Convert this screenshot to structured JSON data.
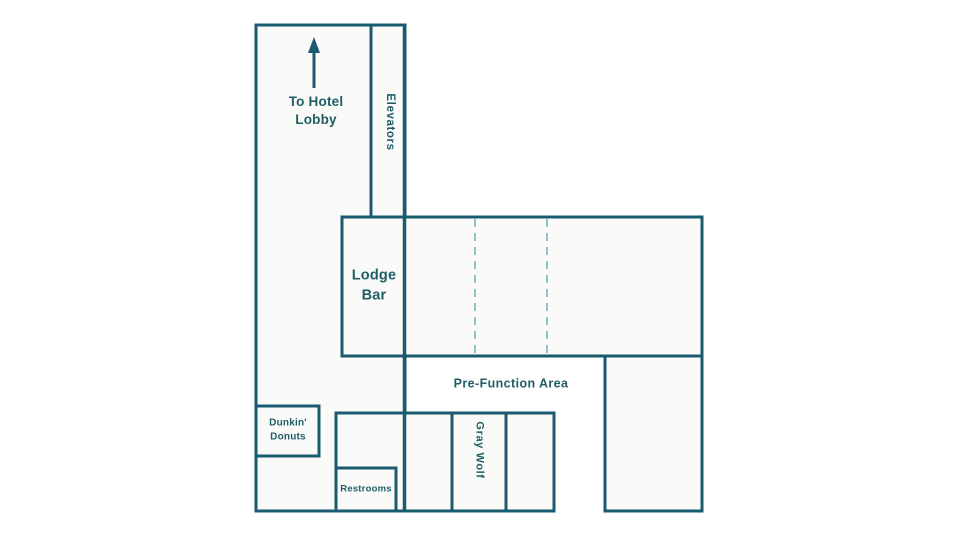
{
  "floor_plan": {
    "labels": {
      "to_hotel_lobby": "To Hotel\nLobby",
      "elevators": "Elevators",
      "lodge_bar": "Lodge\nBar",
      "pre_function_area": "Pre-Function Area",
      "dunkin_donuts": "Dunkin'\nDonuts",
      "restrooms": "Restrooms",
      "gray_wolf": "Gray Wolf"
    },
    "colors": {
      "wall": "#1a5a70",
      "room_fill": "#fafbf9",
      "elevator_shaft_fill": "#edf0ec",
      "gray_wolf_highlight_fill": "#d8e1d9",
      "dashed_partition": "#8fc4ca",
      "label_text": "#1f5d66"
    },
    "icons": {
      "up_arrow": "up-arrow toward hotel lobby"
    }
  }
}
